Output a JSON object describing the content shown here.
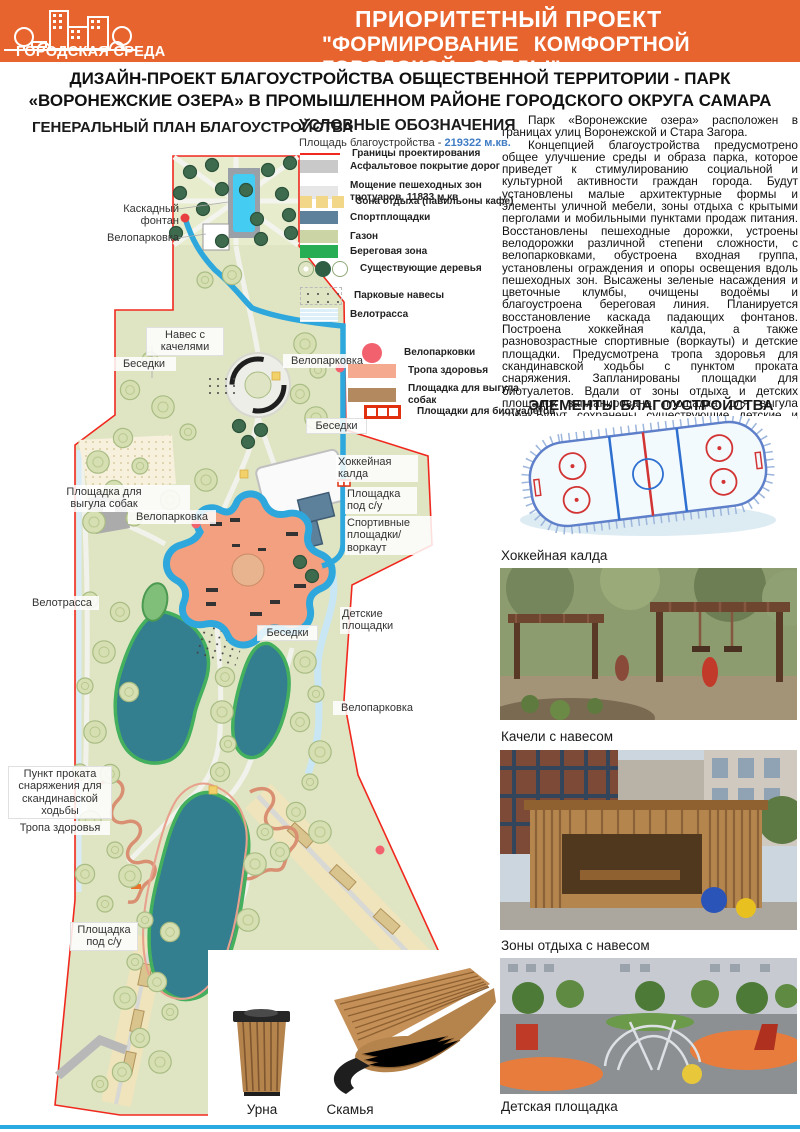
{
  "header": {
    "logo_title": "ГОРОДСКАЯ СРЕДА",
    "line1": "ПРИОРИТЕТНЫЙ ПРОЕКТ",
    "line2": "\"ФОРМИРОВАНИЕ КОМФОРТНОЙ ГОРОДСКОЙ СРЕДЫ\""
  },
  "title": {
    "line1": "ДИЗАЙН-ПРОЕКТ БЛАГОУСТРОЙСТВА ОБЩЕСТВЕННОЙ ТЕРРИТОРИИ - ПАРК",
    "line2": "«ВОРОНЕЖСКИЕ ОЗЕРА» В ПРОМЫШЛЕННОМ РАЙОНЕ ГОРОДСКОГО ОКРУГА САМАРА"
  },
  "plan": {
    "heading": "ГЕНЕРАЛЬНЫЙ ПЛАН БЛАГОУСТРОЙСТВА",
    "labels": [
      {
        "text": "Каскадный фонтан"
      },
      {
        "text": "Велопарковка"
      },
      {
        "text": "Навес с\nкачелями"
      },
      {
        "text": "Беседки"
      },
      {
        "text": "Велопарковка"
      },
      {
        "text": "Беседки"
      },
      {
        "text": "Хоккейная\nкалда"
      },
      {
        "text": "Площадка\nпод с/у"
      },
      {
        "text": "Спортивные\nплощадки/воркаут"
      },
      {
        "text": "Площадка для\nвыгула собак"
      },
      {
        "text": "Велопарковка"
      },
      {
        "text": "Велотрасса"
      },
      {
        "text": "Детские\nплощадки"
      },
      {
        "text": "Беседки"
      },
      {
        "text": "Велопарковка"
      },
      {
        "text": "Пункт проката\nснаряжения для\nскандинавской\nходьбы"
      },
      {
        "text": "Тропа здоровья"
      },
      {
        "text": "Площадка\nпод с/у"
      }
    ]
  },
  "legend": {
    "heading": "УСЛОВНЫЕ ОБОЗНАЧЕНИЯ",
    "area_label": "Площадь благоустройства - ",
    "area_value": "219322 м.кв.",
    "items": [
      {
        "label": "Границы проектирования",
        "color": "#F0281E"
      },
      {
        "label": "Асфальтовое покрытие дорог",
        "color": "#C9C9C9"
      },
      {
        "label": "Мощение пешеходных зон тротуаров, 11833 м.кв",
        "color": "#E6E6E6"
      },
      {
        "label": "Зона отдыха (павильоны кафе)",
        "color": "#F2D788"
      },
      {
        "label": "Спортплощадки",
        "color": "#5D809B"
      },
      {
        "label": "Газон",
        "color": "#CBD4A4"
      },
      {
        "label": "Береговая зона",
        "color": "#27AE55"
      },
      {
        "label": "Существующие деревья",
        "color": "#2F5E45"
      },
      {
        "label": "Парковые навесы",
        "color": "#555555"
      },
      {
        "label": "Велотрасса",
        "color": "#DDEFF8"
      }
    ],
    "items2": [
      {
        "label": "Велопарковки",
        "color": "#F2626E"
      },
      {
        "label": "Тропа здоровья",
        "color": "#F5A98F"
      },
      {
        "label": "Площадка для выгула\nсобак",
        "color": "#B38A5F"
      },
      {
        "label": "Площадки для биотуалетов",
        "color": "#E03010"
      }
    ]
  },
  "description": {
    "p1": "Парк «Воронежские озера» расположен в границах улиц Воронежской и Стара Загора.",
    "p2": "Концепцией благоустройства предусмотрено общее улучшение среды и образа парка, которое приведет к стимулированию социальной и культурной активности граждан города. Будут установлены малые архитектурные формы и элементы уличной мебели,  зоны отдыха с крытыми перголами и мобильными пунктами продаж питания. Восстановлены пешеходные дорожки, устроены велодорожки различной степени сложности, с велопарковками, обустроена входная группа, установлены ограждения и опоры освещения вдоль пешеходных зон. Высажены зеленые насаждения и цветочные клумбы, очищены водоёмы и благоустроена береговая линия. Планируется восстановление каскада падающих фонтанов. Построена хоккейная калда, а также разновозрастные спортивные (воркауты) и детские площадки. Предусмотрена тропа здоровья для скандинавской ходьбы с пунктом проката снаряжения. Запланированы площадки для биотуалетов. Вдали от зоны отдыха и детских площадок запланирована площадка для выгула собак.Будут сохранены существующие детские и спортивные площадки, а также зеленые насаждения."
  },
  "elements": {
    "heading": "ЭЛЕМЕНТЫ БЛАГОУСТРОЙСТВА",
    "photos": [
      {
        "caption": "Хоккейная калда"
      },
      {
        "caption": "Качели с навесом"
      },
      {
        "caption": "Зоны отдыха с навесом"
      },
      {
        "caption": "Детская площадка"
      }
    ]
  },
  "furniture": {
    "items": [
      {
        "label": "Урна"
      },
      {
        "label": "Скамья"
      }
    ]
  },
  "colors": {
    "header_orange": "#E8642F",
    "boundary_red": "#F0281E",
    "bike_path_blue": "#2EA7DC",
    "park_green": "#DFE5C3",
    "lake_teal": "#337E8F",
    "playground_orange": "#F2A080",
    "bottom_rule_blue": "#29ABE2",
    "area_value_blue": "#3F7CC4"
  }
}
